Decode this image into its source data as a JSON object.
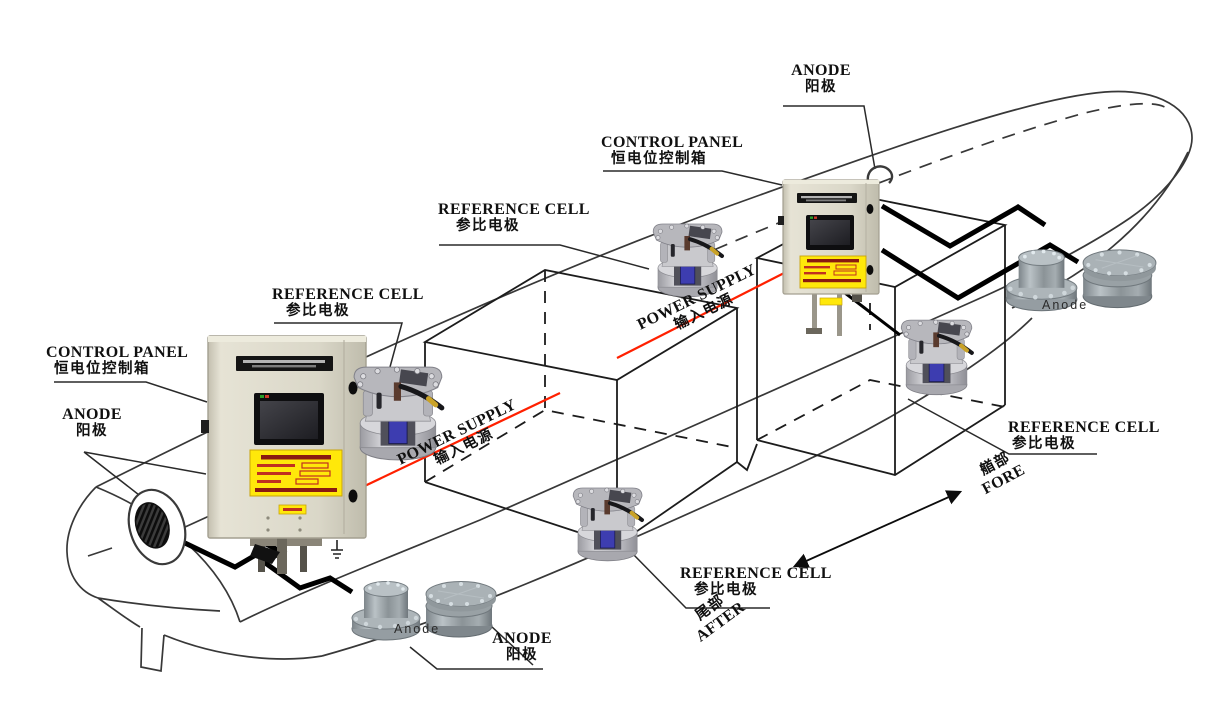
{
  "diagram_type": "ship ICCP cathodic protection system arrangement",
  "colors": {
    "background": "#ffffff",
    "outline": "#333333",
    "cable": "#000000",
    "power_line_red": "#ff2000",
    "panel_beige": "#d9d6c7",
    "warning_yellow": "#ffe80a",
    "screen_dark": "#16161a",
    "metal_gray": "#a9b0b4",
    "refcell_blue": "#3d3db0"
  },
  "callouts": {
    "anode_fore": {
      "en": "ANODE",
      "zh": "阳极"
    },
    "control_panel_fore": {
      "en": "CONTROL PANEL",
      "zh": "恒电位控制箱"
    },
    "reference_cell_fore_top": {
      "en": "REFERENCE CELL",
      "zh": "参比电极"
    },
    "reference_cell_aft_top": {
      "en": "REFERENCE CELL",
      "zh": "参比电极"
    },
    "control_panel_aft": {
      "en": "CONTROL PANEL",
      "zh": "恒电位控制箱"
    },
    "anode_aft_hull": {
      "en": "ANODE",
      "zh": "阳极"
    },
    "power_supply_aft": {
      "en": "POWER SUPPLY",
      "zh": "输入电源"
    },
    "power_supply_fore": {
      "en": "POWER SUPPLY",
      "zh": "输入电源"
    },
    "reference_cell_aft_bottom": {
      "en": "REFERENCE CELL",
      "zh": "参比电极"
    },
    "reference_cell_fore_right": {
      "en": "REFERENCE CELL",
      "zh": "参比电极"
    },
    "anode_aft_bottom": {
      "en": "ANODE",
      "zh": "阳极"
    },
    "direction_aft": {
      "zh": "尾部",
      "en": "AFTER"
    },
    "direction_fore": {
      "zh": "艏部",
      "en": "FORE"
    },
    "anode_tag_aft": "Anode",
    "anode_tag_fore": "Anode"
  }
}
